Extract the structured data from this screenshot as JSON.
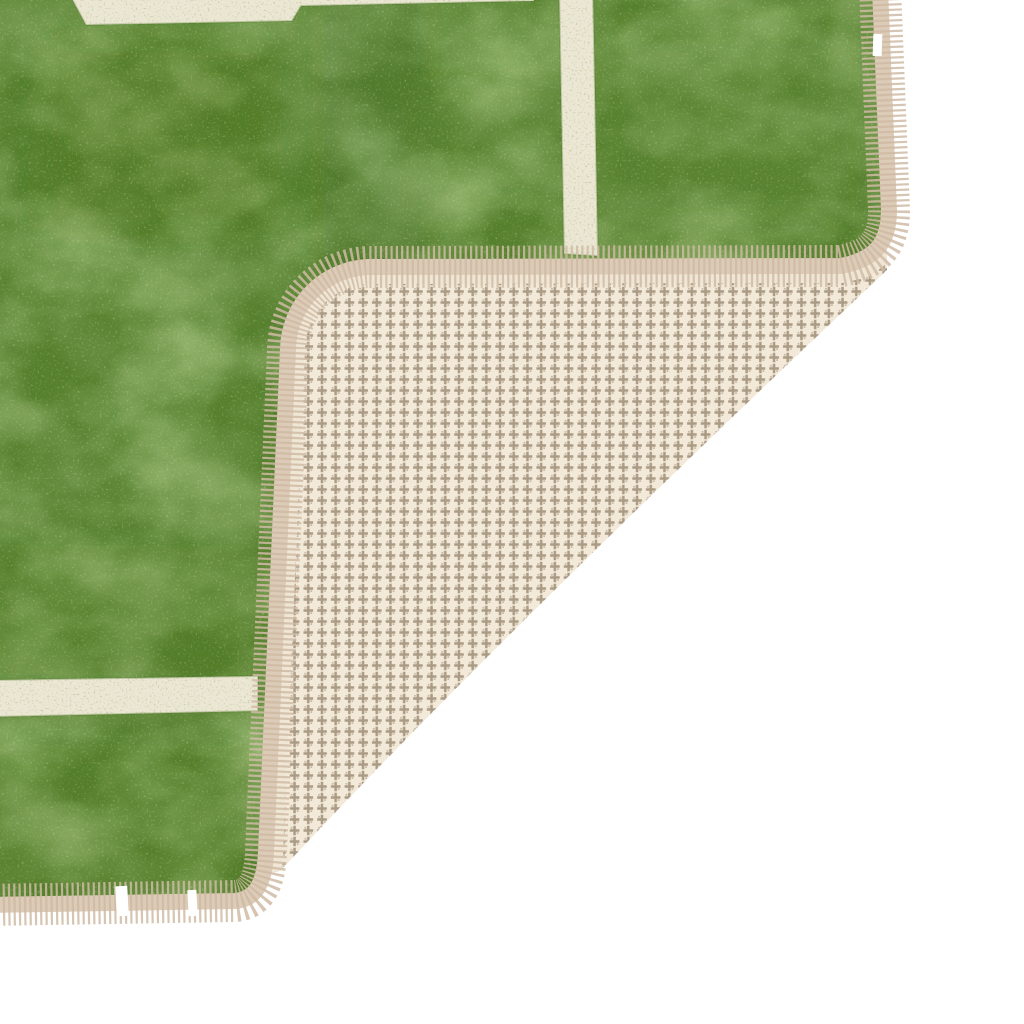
{
  "scene": {
    "description": "Product photo of a washable football-pitch play rug: green pile with off-white field lines, top-right corner folded over showing cream houndstooth anti-slip backing and beige whip-stitched binding, on a plain white background",
    "background_color": "#ffffff"
  },
  "rug": {
    "pile_green_base": "#56802e",
    "pile_green_light": "#72a045",
    "pile_green_dark": "#3f6420",
    "pile_grain_dark": "#2a4712",
    "pile_grain_light": "#b7d488",
    "field_line_color": "#ece7d4",
    "field_line_edge_shade": "#4c7226",
    "binding_color": "#dccbb6",
    "binding_margin_color": "#f0e6d5",
    "fringe_color": "#cfbba4",
    "backing_base_color": "#f3e9d8",
    "backing_motif_color": "#a4957e",
    "notch_color": "#ffffff"
  },
  "geometry_notes": {
    "vertical_field_line_x": "559-598",
    "bottom_field_line_y": "676-717",
    "fold_crease": "from (887,270) to (283,868)",
    "bound_edges": "right edge, folded flap top/left edge, bottom edge"
  }
}
